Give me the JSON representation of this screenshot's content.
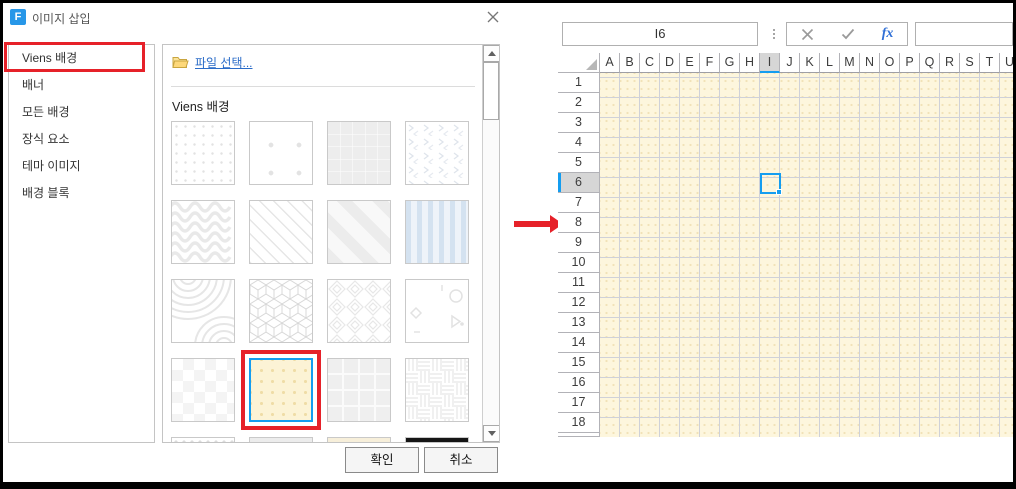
{
  "window": {
    "title": "이미지 삽입",
    "logo_letter": "F"
  },
  "dialog": {
    "sidebar": {
      "items": [
        {
          "label": "Viens 배경",
          "selected": true,
          "highlighted_red": true
        },
        {
          "label": "배너"
        },
        {
          "label": "모든 배경"
        },
        {
          "label": "장식 요소"
        },
        {
          "label": "테마 이미지"
        },
        {
          "label": "배경 블록"
        }
      ]
    },
    "file_select_label": "파일 선택...",
    "section_title": "Viens 배경",
    "patterns": [
      {
        "id": "dots-grid",
        "label": "small dots grid"
      },
      {
        "id": "sparse-dots",
        "label": "sparse dots"
      },
      {
        "id": "squares-grid",
        "label": "gray squares grid"
      },
      {
        "id": "chevrons",
        "label": "tiny chevrons"
      },
      {
        "id": "waves",
        "label": "wavy lines"
      },
      {
        "id": "diag-thin",
        "label": "thin diagonal lines"
      },
      {
        "id": "diag-wide",
        "label": "wide diagonal stripes"
      },
      {
        "id": "blue-stripes",
        "label": "blue vertical stripes"
      },
      {
        "id": "arcs",
        "label": "concentric arcs"
      },
      {
        "id": "cubes",
        "label": "isometric cube lattice"
      },
      {
        "id": "greek",
        "label": "diamond maze"
      },
      {
        "id": "shapes",
        "label": "scattered geometric shapes"
      },
      {
        "id": "checkerboard",
        "label": "subtle checkerboard"
      },
      {
        "id": "yellow-dots",
        "label": "cream dotted background",
        "selected": true,
        "highlighted_red": true
      },
      {
        "id": "textured-tiles",
        "label": "basket weave tiles"
      },
      {
        "id": "weave",
        "label": "textured squares"
      },
      {
        "id": "dotted-strip",
        "label": "partial row thumbnail",
        "partial": true
      },
      {
        "id": "gray-strip",
        "label": "partial row thumbnail",
        "partial": true
      },
      {
        "id": "cream-strip",
        "label": "partial row thumbnail",
        "partial": true
      },
      {
        "id": "black-strip",
        "label": "partial row thumbnail",
        "partial": true
      }
    ],
    "ok_label": "확인",
    "cancel_label": "취소"
  },
  "sheet": {
    "name_box_value": "I6",
    "formula_value": "",
    "fx_label": "fx",
    "columns": [
      "A",
      "B",
      "C",
      "D",
      "E",
      "F",
      "G",
      "H",
      "I",
      "J",
      "K",
      "L",
      "M",
      "N",
      "O",
      "P",
      "Q",
      "R",
      "S",
      "T",
      "U"
    ],
    "rows": [
      "1",
      "2",
      "3",
      "4",
      "5",
      "6",
      "7",
      "8",
      "9",
      "10",
      "11",
      "12",
      "13",
      "14",
      "15",
      "16",
      "17",
      "18"
    ],
    "selected_cell": "I6",
    "selected_column": "I",
    "selected_row": "6"
  },
  "colors": {
    "highlight_red": "#e62129",
    "selection_blue": "#149df0",
    "link_blue": "#2b6cc8",
    "fx_blue": "#2f6fd6",
    "logo_blue": "#2797e8",
    "cell_background": "#fdf6dd",
    "cell_dot": "#f1e3bb",
    "header_selected_gray": "#d6d6d6"
  }
}
